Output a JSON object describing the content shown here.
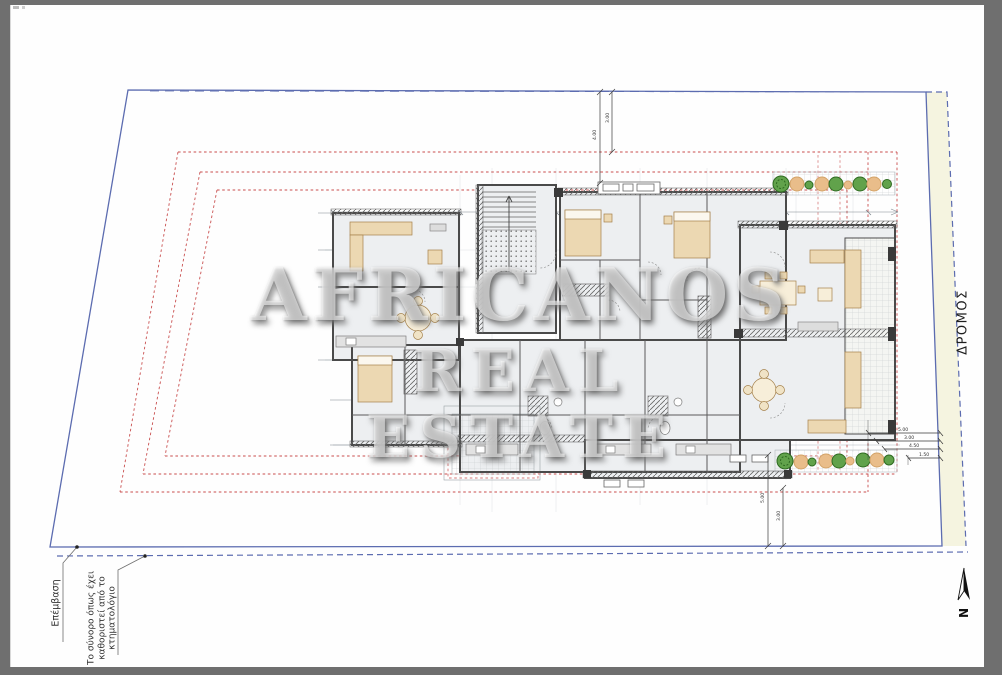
{
  "watermark": {
    "line1": "AFRICANOS",
    "line2": "REAL ESTATE"
  },
  "labels": {
    "road": "ΔΡΟΜΟΣ",
    "north": "N",
    "annotation_intervention": "Επέμβαση",
    "annotation_boundary_l1": "Το σύνορο όπως έχει",
    "annotation_boundary_l2": "καθοριστεί από το",
    "annotation_boundary_l3": "κτηματολόγιο"
  },
  "dimensions": {
    "top_a": "4.00",
    "top_b": "3.00",
    "bottom_a": "5.00",
    "bottom_b": "3.00",
    "right_a": "5.00",
    "right_b": "3.00",
    "right_c": "4.50",
    "right_d": "1.50"
  },
  "colors": {
    "frame_gray": "#6f6f6f",
    "paper": "#fefefe",
    "boundary_blue": "#5c6cb0",
    "setback_red": "#c94f4f",
    "road_fill": "#f5f4e0",
    "wall_dark": "#454545",
    "room_fill": "#edeff1",
    "furniture_tan": "#ecd8b2",
    "tree_green": "#61a24b",
    "tree_orange": "#e9bd8a"
  }
}
